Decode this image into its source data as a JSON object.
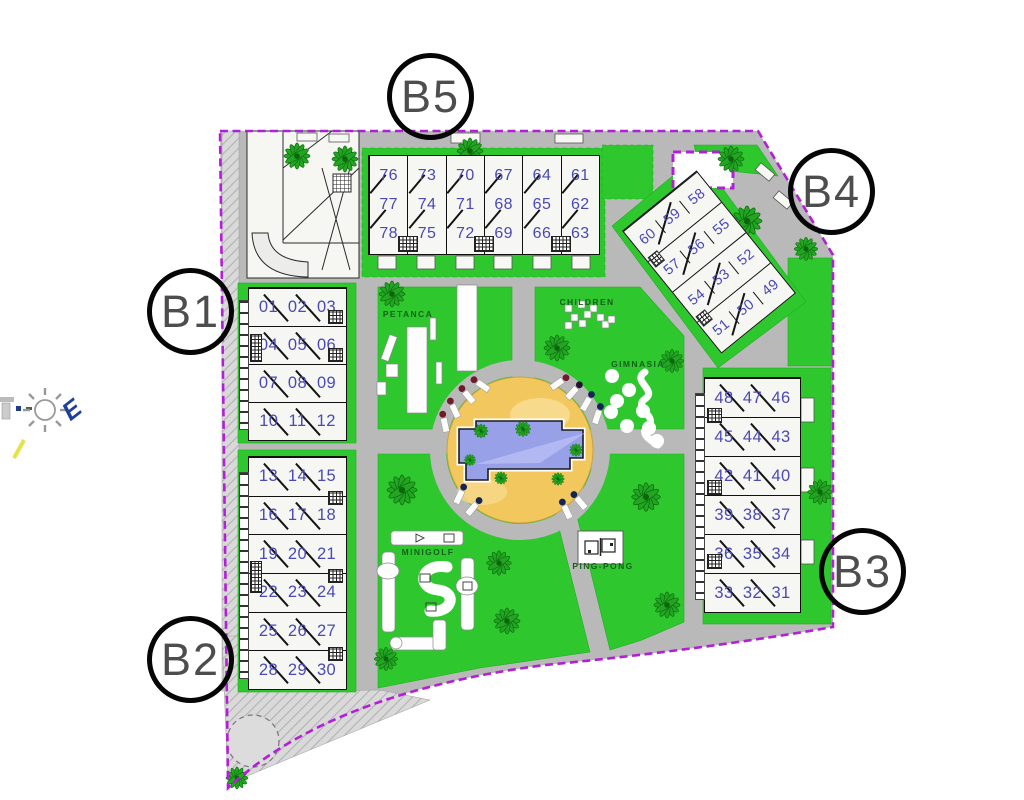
{
  "site": {
    "blocks": [
      {
        "id": "B1",
        "label": "B1",
        "rows": [
          [
            "01",
            "02",
            "03"
          ],
          [
            "04",
            "05",
            "06"
          ],
          [
            "07",
            "08",
            "09"
          ],
          [
            "10",
            "11",
            "12"
          ]
        ]
      },
      {
        "id": "B2",
        "label": "B2",
        "rows": [
          [
            "13",
            "14",
            "15"
          ],
          [
            "16",
            "17",
            "18"
          ],
          [
            "19",
            "20",
            "21"
          ],
          [
            "22",
            "23",
            "24"
          ],
          [
            "25",
            "26",
            "27"
          ],
          [
            "28",
            "29",
            "30"
          ]
        ]
      },
      {
        "id": "B3",
        "label": "B3",
        "rows": [
          [
            "48",
            "47",
            "46"
          ],
          [
            "45",
            "44",
            "43"
          ],
          [
            "42",
            "41",
            "40"
          ],
          [
            "39",
            "38",
            "37"
          ],
          [
            "36",
            "35",
            "34"
          ],
          [
            "33",
            "32",
            "31"
          ]
        ]
      },
      {
        "id": "B4",
        "label": "B4",
        "rows": [
          [
            "60",
            "59",
            "58"
          ],
          [
            "57",
            "56",
            "55"
          ],
          [
            "54",
            "53",
            "52"
          ],
          [
            "51",
            "50",
            "49"
          ]
        ]
      },
      {
        "id": "B5",
        "label": "B5",
        "columns": [
          [
            "76",
            "77",
            "78"
          ],
          [
            "73",
            "74",
            "75"
          ],
          [
            "70",
            "71",
            "72"
          ],
          [
            "67",
            "68",
            "69"
          ],
          [
            "64",
            "65",
            "66"
          ],
          [
            "61",
            "62",
            "63"
          ]
        ]
      }
    ],
    "amenities": {
      "petanca": "PETANCA",
      "children": "CHILDREN",
      "gimnasia": "GIMNASIA",
      "minigolf": "MINIGOLF",
      "pingpong": "PING-PONG"
    },
    "compass": {
      "east": "E"
    },
    "colors": {
      "lawn": "#2ec82e",
      "road": "#b9b9b9",
      "boundary": "#b21fd6",
      "pool_water": "#98a0e8",
      "pool_deck": "#f2c75e",
      "unit_number": "#4a49b6",
      "amenity_label": "#14601a"
    }
  }
}
